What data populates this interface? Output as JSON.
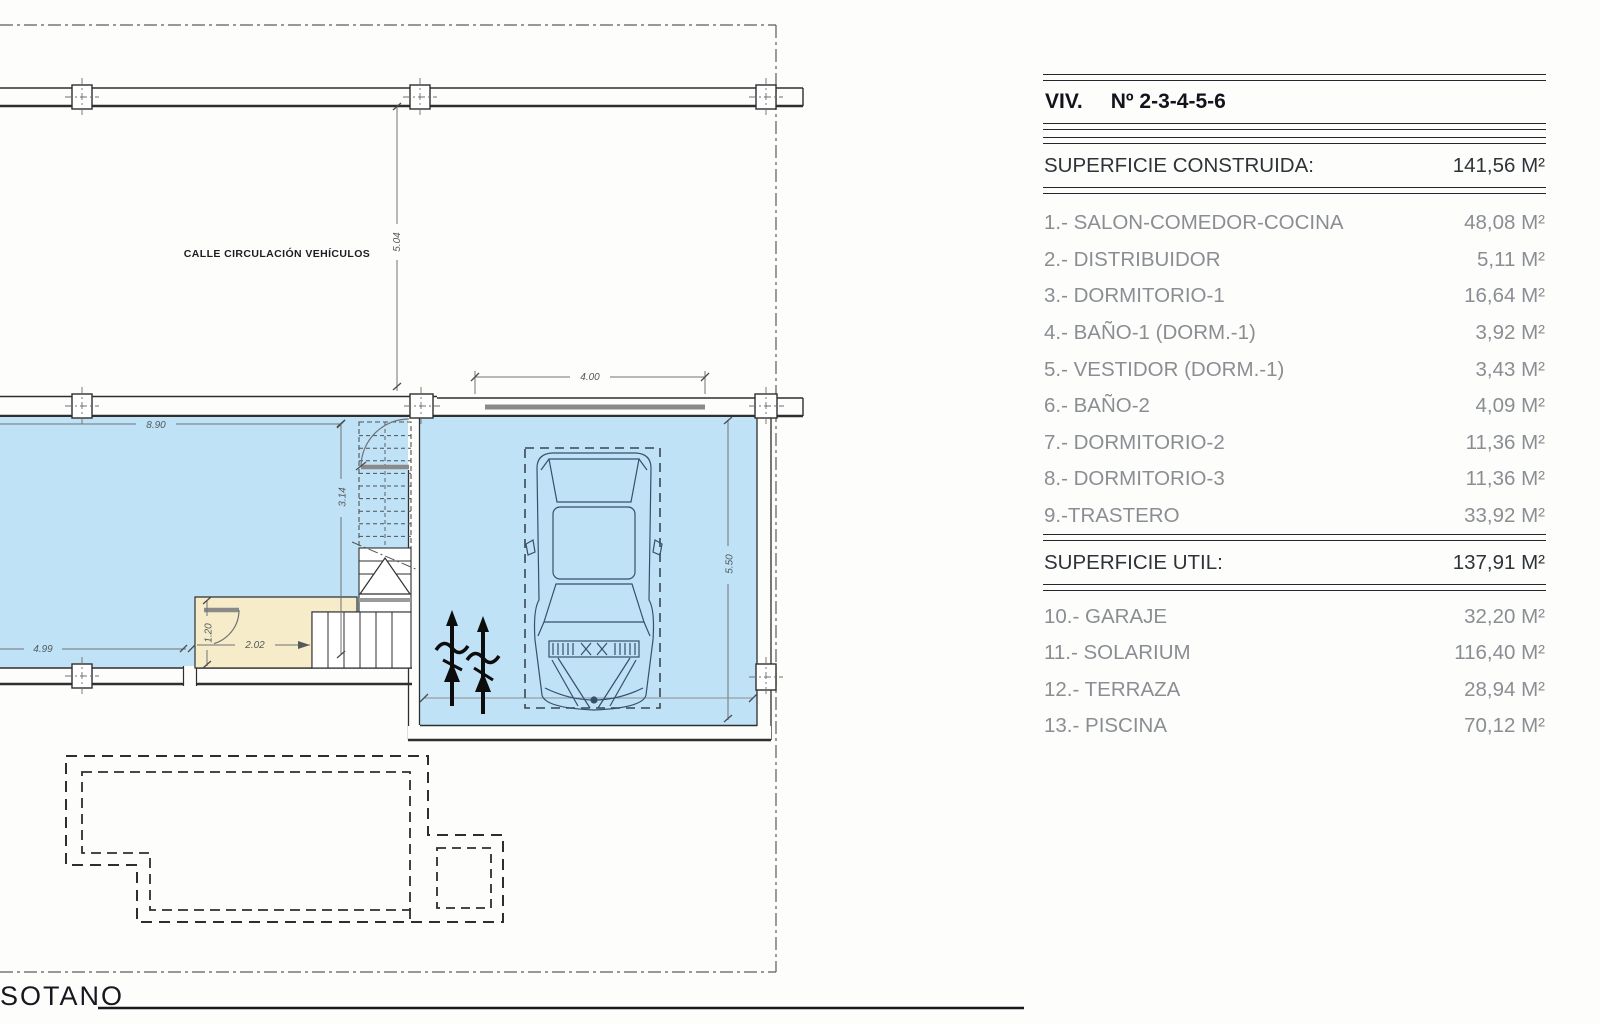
{
  "plan": {
    "street_label": "CALLE CIRCULACIÓN VEHÍCULOS",
    "level_label": "SOTANO",
    "dims": {
      "street_depth": "5.04",
      "room_width": "8.90",
      "room_height": "3.14",
      "room_bottom": "4.99",
      "hall_depth": "1.20",
      "hall_width": "2.02",
      "garage_width": "4.00",
      "garage_depth": "5.50"
    },
    "colors": {
      "room_fill": "#bfe2f7",
      "hall_fill": "#f6ecc9",
      "wall_line": "#2f2f2f",
      "dim_line": "#6f7276"
    }
  },
  "table": {
    "title": "VIV.",
    "title_number": "Nº 2-3-4-5-6",
    "built_label": "SUPERFICIE CONSTRUIDA:",
    "built_value": "141,56 M²",
    "useful_label": "SUPERFICIE UTIL:",
    "useful_value": "137,91 M²",
    "rooms": [
      {
        "label": "1.- SALON-COMEDOR-COCINA",
        "value": "48,08 M²"
      },
      {
        "label": "2.- DISTRIBUIDOR",
        "value": "5,11 M²"
      },
      {
        "label": "3.- DORMITORIO-1",
        "value": "16,64 M²"
      },
      {
        "label": "4.- BAÑO-1 (DORM.-1)",
        "value": "3,92 M²"
      },
      {
        "label": "5.- VESTIDOR (DORM.-1)",
        "value": "3,43 M²"
      },
      {
        "label": "6.- BAÑO-2",
        "value": "4,09 M²"
      },
      {
        "label": "7.- DORMITORIO-2",
        "value": "11,36 M²"
      },
      {
        "label": "8.- DORMITORIO-3",
        "value": "11,36 M²"
      },
      {
        "label": "9.-TRASTERO",
        "value": "33,92 M²"
      }
    ],
    "extras": [
      {
        "label": "10.- GARAJE",
        "value": "32,20 M²"
      },
      {
        "label": "11.- SOLARIUM",
        "value": "116,40 M²"
      },
      {
        "label": "12.- TERRAZA",
        "value": "28,94 M²"
      },
      {
        "label": "13.- PISCINA",
        "value": "70,12 M²"
      }
    ]
  }
}
